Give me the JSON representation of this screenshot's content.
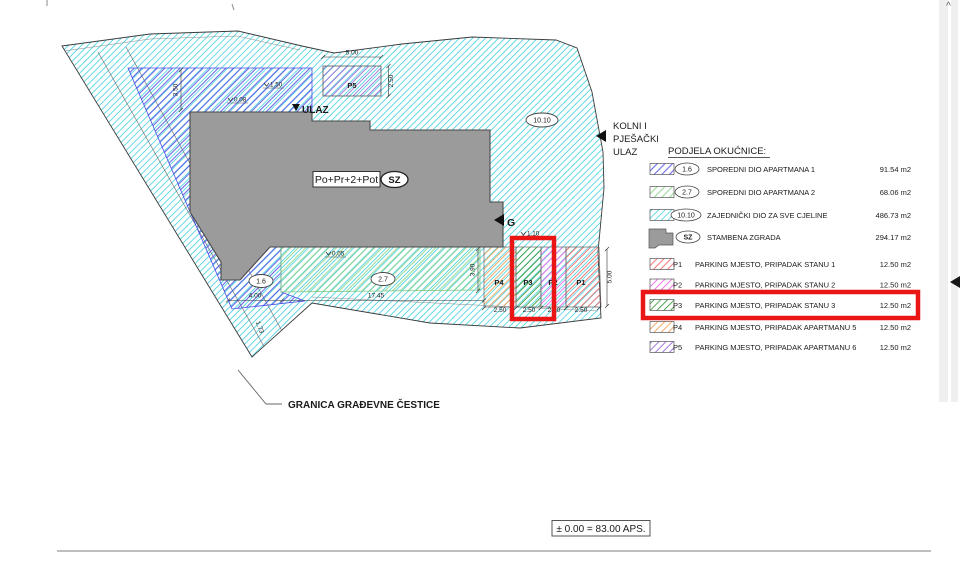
{
  "colors": {
    "highlight_box": "#ea1515",
    "parcel_cyan": "#3fd0e0",
    "apartment1_blue": "#4a4ae6",
    "apartment2_green": "#86d286",
    "building_gray": "#9b9b9b",
    "p1_red": "#f26b6b",
    "p2_magenta": "#ec63ec",
    "p3_green": "#3f9e3f",
    "p4_orange": "#f2a258",
    "p5_purple": "#9a6bd8"
  },
  "icons": {
    "scroll_up": "^"
  },
  "plan": {
    "entrance_label": "ULAZ",
    "gas_label": "G",
    "access_lines": [
      "KOLNI I",
      "PJEŠAČKI",
      "ULAZ"
    ],
    "building_floors": "Po+Pr+2+Pot",
    "building_code": "SZ",
    "badge_apartment1": "1.6",
    "badge_apartment2": "2.7",
    "badge_common": "10.10",
    "stall_p1": "P1",
    "stall_p2": "P2",
    "stall_p3": "P3",
    "stall_p4": "P4",
    "stall_p5": "P5",
    "dim_p5_width": "5.00",
    "dim_p5_depth": "2.50",
    "dim_band_height": "3.50",
    "dim_green_length": "17.45",
    "dim_green_height": "3.90",
    "dim_blue_length": "4.00",
    "dim_diagonal": "1.73",
    "dim_stall_depth": "5.00",
    "dim_stall_width": "2.50",
    "level_band": "1.50",
    "level_entrance": "0.08",
    "level_green": "0.05",
    "level_parking": "1.10",
    "boundary_label": "GRANICA  GRAĐEVNE ČESTICE",
    "datum_note": "± 0.00 = 83.00 APS."
  },
  "legend": {
    "title": "PODJELA OKUĆNICE:",
    "rows": [
      {
        "code": "1.6",
        "label": "SPOREDNI DIO APARTMANA 1",
        "area": "91.54 m2"
      },
      {
        "code": "2.7",
        "label": "SPOREDNI DIO APARTMANA 2",
        "area": "68.06 m2"
      },
      {
        "code": "10.10",
        "label": "ZAJEDNIČKI DIO ZA SVE CJELINE",
        "area": "486.73 m2"
      },
      {
        "code": "SZ",
        "label": "STAMBENA ZGRADA",
        "area": "294.17 m2"
      },
      {
        "code": "P1",
        "label": "PARKING MJESTO, PRIPADAK STANU 1",
        "area": "12.50 m2"
      },
      {
        "code": "P2",
        "label": "PARKING MJESTO, PRIPADAK STANU 2",
        "area": "12.50 m2"
      },
      {
        "code": "P3",
        "label": "PARKING MJESTO, PRIPADAK STANU 3",
        "area": "12.50 m2"
      },
      {
        "code": "P4",
        "label": "PARKING MJESTO, PRIPADAK APARTMANU 5",
        "area": "12.50 m2"
      },
      {
        "code": "P5",
        "label": "PARKING MJESTO, PRIPADAK APARTMANU 6",
        "area": "12.50 m2"
      }
    ]
  }
}
